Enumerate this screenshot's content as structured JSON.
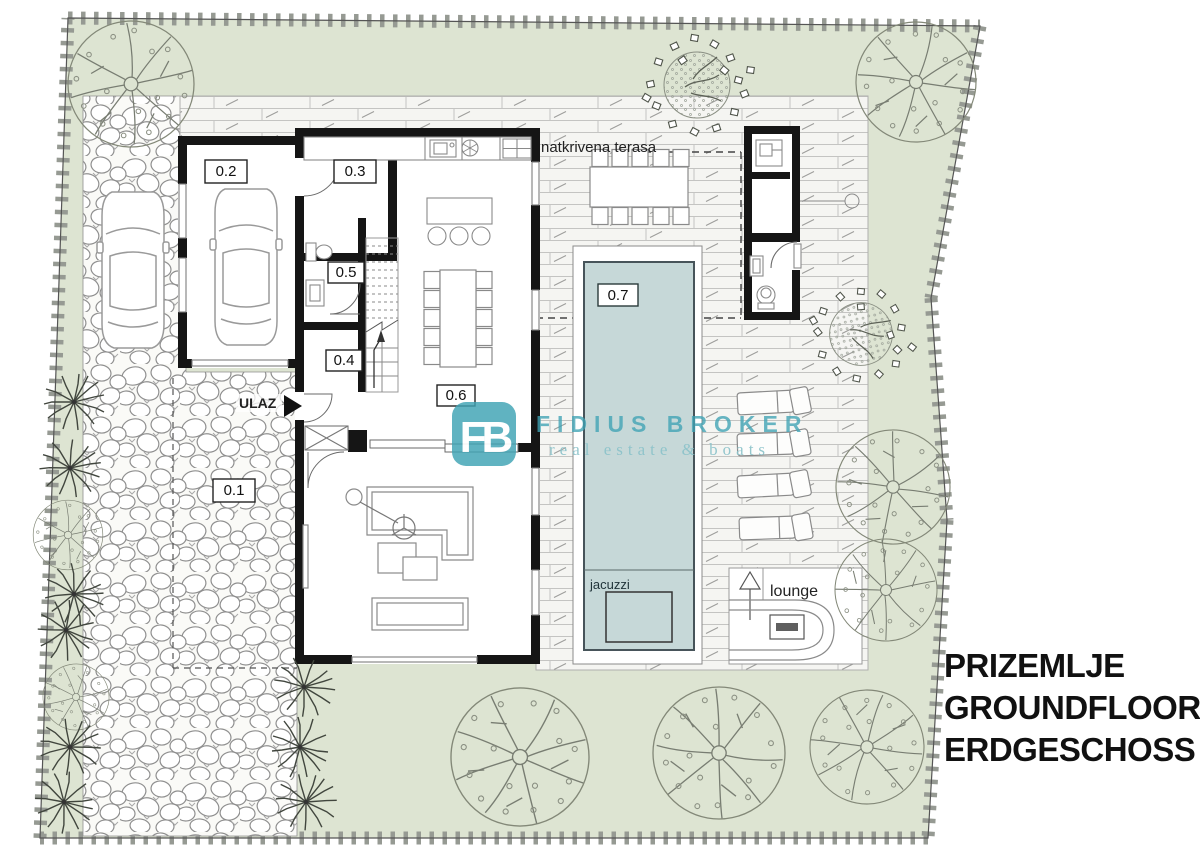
{
  "plan": {
    "floor_title": {
      "line1": "PRIZEMLJE",
      "line2": "GROUNDFLOOR",
      "line3": "ERDGESCHOSS"
    },
    "rooms": {
      "r01": "0.1",
      "r02": "0.2",
      "r03": "0.3",
      "r04": "0.4",
      "r05": "0.5",
      "r06": "0.6",
      "r07": "0.7"
    },
    "labels": {
      "entrance": "ULAZ",
      "covered_terrace": "natkrivena terasa",
      "jacuzzi": "jacuzzi",
      "lounge": "lounge"
    },
    "watermark": {
      "logo": "FB",
      "name": "FIDIUS BROKER",
      "tagline": "real estate & boats"
    },
    "colors": {
      "lawn": "#dde4d2",
      "pool_water": "#c6d8d8",
      "wall": "#151515",
      "boundary_tie": "#969a93",
      "watermark_teal": "#3fa3b4",
      "watermark_light": "#8cc3ca"
    }
  }
}
